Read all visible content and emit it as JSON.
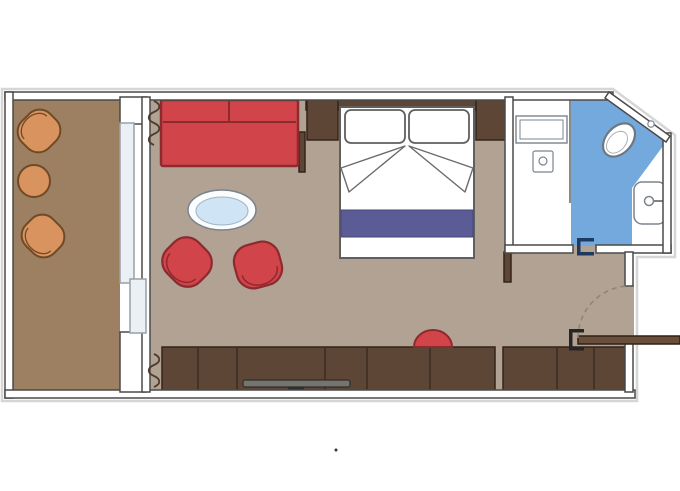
{
  "plan": {
    "kind": "cruise-cabin-floor-plan",
    "rooms": [
      {
        "name": "balcony",
        "items": [
          "lounge-chair",
          "round-side-table",
          "lounge-chair"
        ]
      },
      {
        "name": "bedroom",
        "items": [
          "sofa",
          "oval-coffee-table",
          "tub-armchair",
          "tub-armchair",
          "double-bed",
          "pillow",
          "pillow",
          "nightstand",
          "nightstand",
          "wardrobe-cabinets",
          "tv",
          "stool",
          "curtain",
          "curtain",
          "sliding-glass-door"
        ]
      },
      {
        "name": "bathroom",
        "items": [
          "shower",
          "shower-bench",
          "drain",
          "toilet",
          "washbasin",
          "pocket-door"
        ]
      },
      {
        "name": "entry",
        "items": [
          "entrance-door",
          "door-swing-arc"
        ]
      }
    ]
  },
  "colors": {
    "background": "#ffffff",
    "wall_fill": "#ffffff",
    "wall_outline": "#4a4a4a",
    "halo_gray": "#d6d6d6",
    "balcony_floor": "#9d7f62",
    "room_floor": "#b1a294",
    "wood_dark": "#5e4637",
    "wood_outline": "#33241a",
    "accent_red": "#d14449",
    "accent_red_outline": "#8c2a2e",
    "orange_chair": "#d9935f",
    "orange_outline": "#6f4a26",
    "bathroom_blue": "#74a9dd",
    "blanket_indigo": "#5b5c95",
    "blanket_outline": "#45467b",
    "table_blue": "#cfe4f5",
    "fixture_outline": "#7b848c",
    "bed_outline": "#5f5f5f",
    "door_navy": "#1e3a5f",
    "jamb_black": "#262626",
    "door_leaf": "#6a4f3d",
    "swing_dash": "#94846f",
    "curtain_brown": "#4e3a2c",
    "tv_gray": "#75756d",
    "tv_dark": "#2f2f2f",
    "sliding_door_fill": "#eaf0f4",
    "sliding_door_outline": "#97a1a8"
  }
}
